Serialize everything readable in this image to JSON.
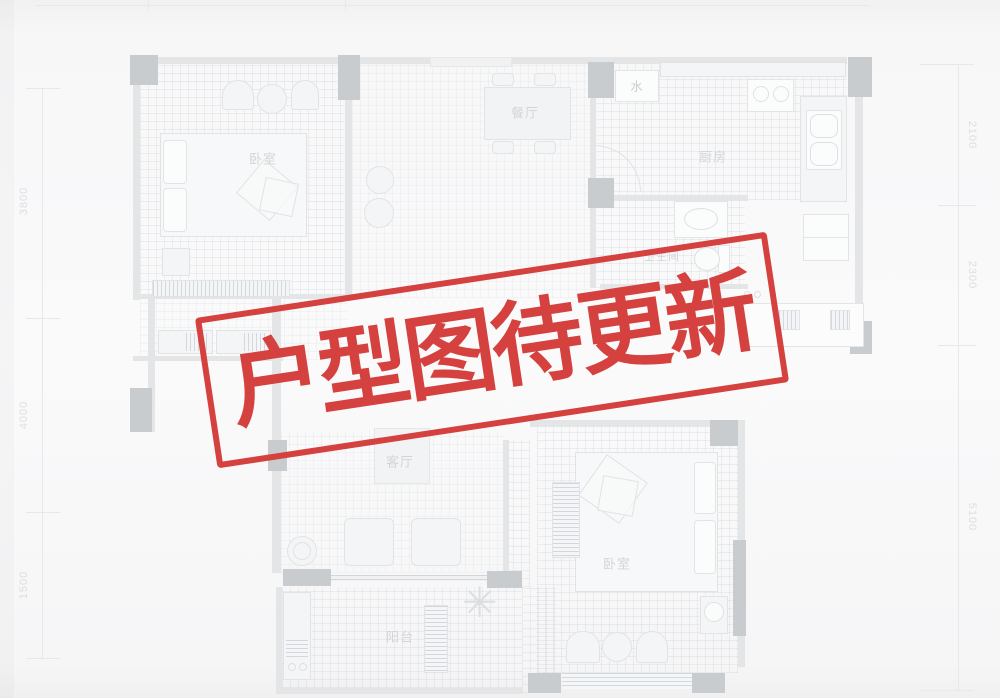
{
  "stamp": {
    "text": "户型图待更新",
    "color": "#d5413f"
  },
  "rooms": {
    "bedroom_top_left": "卧室",
    "dining": "餐厅",
    "kitchen": "厨房",
    "water_meter": "水",
    "bathroom": "卫生间",
    "living": "客厅",
    "balcony": "阳台",
    "bedroom_bottom_right": "卧室"
  },
  "dimensions": {
    "left": [
      "3800",
      "4000",
      "1500"
    ],
    "right": [
      "2100",
      "2300",
      "5100"
    ]
  },
  "icons": {
    "plant": "✳"
  }
}
